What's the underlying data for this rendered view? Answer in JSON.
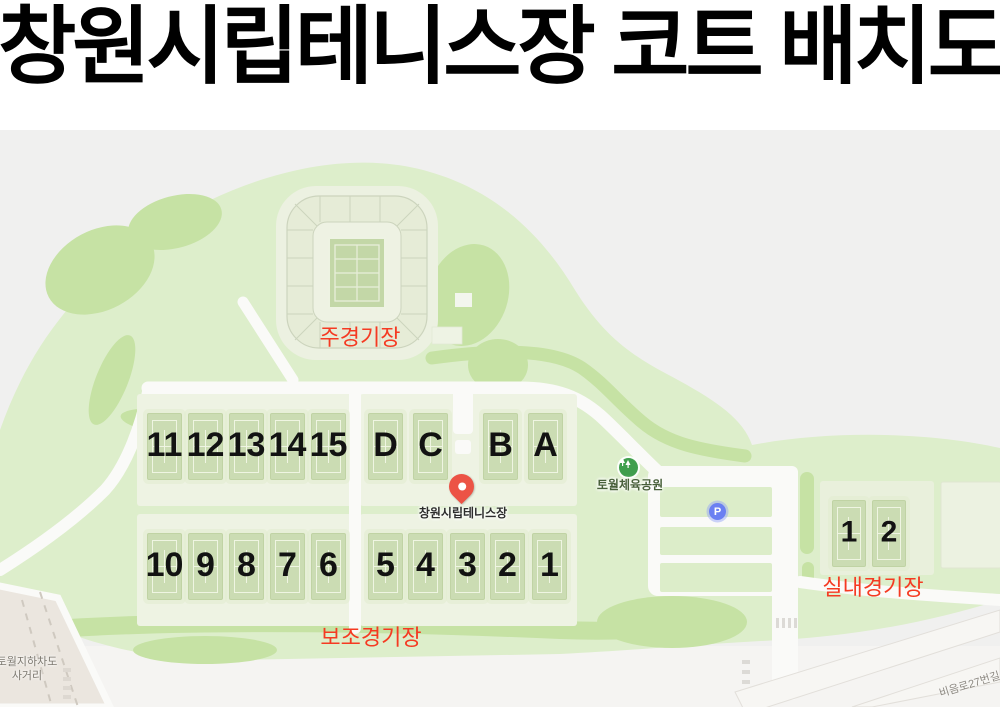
{
  "title": "창원시립테니스장 코트 배치도",
  "map": {
    "stadium_label": "주경기장",
    "aux_label": "보조경기장",
    "indoor_label": "실내경기장",
    "pin_label": "창원시립테니스장",
    "park_poi_label": "토월체육공원",
    "parking_icon": "P",
    "intersection_label_line1": "토월지하차도",
    "intersection_label_line2": "사거리",
    "road_label": "비음로27번길",
    "courts_top_left": [
      "11",
      "12",
      "13",
      "14",
      "15"
    ],
    "courts_top_right": [
      "D",
      "C",
      "B",
      "A"
    ],
    "courts_bottom_left": [
      "10",
      "9",
      "8",
      "7",
      "6"
    ],
    "courts_bottom_right": [
      "5",
      "4",
      "3",
      "2",
      "1"
    ],
    "courts_indoor": [
      "1",
      "2"
    ]
  },
  "colors": {
    "accent_red": "#f53a22",
    "park_green": "#ddeecb",
    "tree_green": "#c6e2a4",
    "court_green": "#cbdcb3",
    "panel_green": "#eef3e3",
    "pin_red": "#ec5345",
    "parking_blue": "#6b80f2",
    "poi_green": "#3f9e4d",
    "map_bg": "#f0f0ef"
  }
}
